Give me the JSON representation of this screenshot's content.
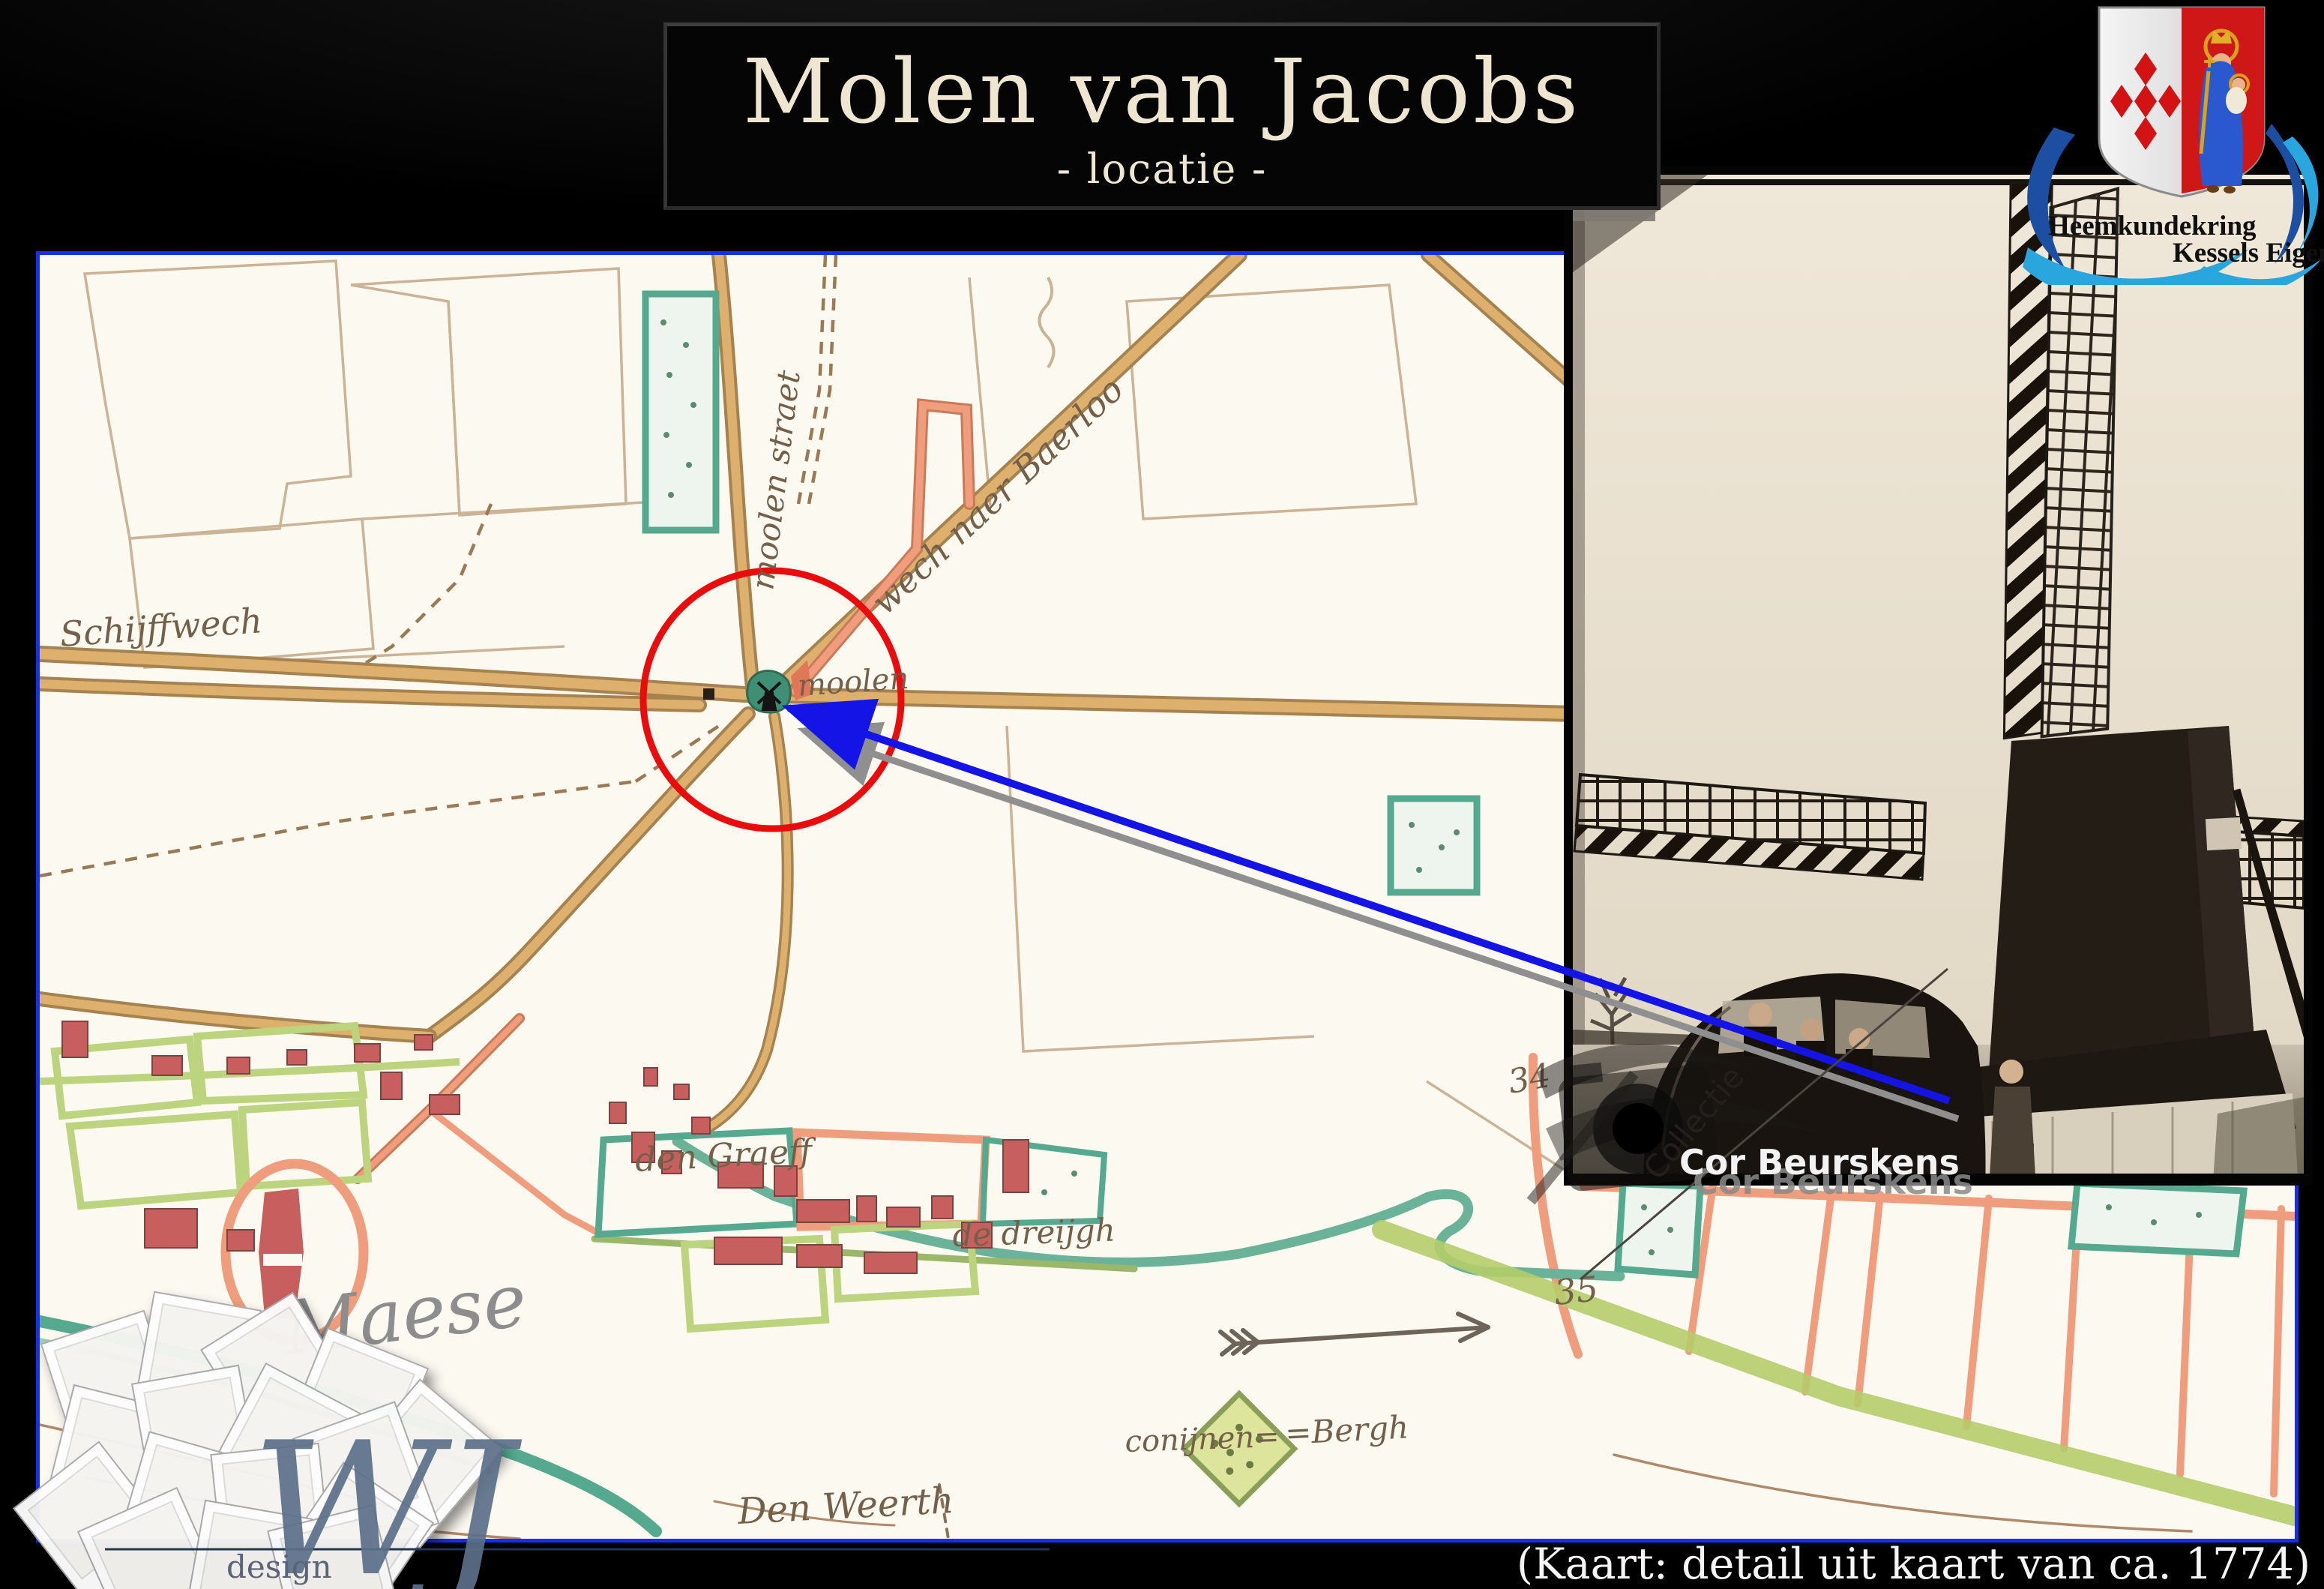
{
  "slide": {
    "title": "Molen van Jacobs",
    "subtitle": "- locatie -",
    "caption": "(Kaart: detail uit kaart van ca. 1774)",
    "background_color": "#000000",
    "title_color": "#efe6d2"
  },
  "logo": {
    "line1": "Heemkundekring",
    "line2": "Kessels Eigen",
    "shield_left_color": "#e2e2e2",
    "shield_right_color": "#cf1717",
    "lozenge_color": "#d31313",
    "swoosh_dark_color": "#1c4fa1",
    "swoosh_light_color": "#2aa6df"
  },
  "map": {
    "paper_color": "#fcf9f1",
    "border_color": "#1430ee",
    "highlight_circle_color": "#ea0c0c",
    "pointer_color": "#1414e6",
    "labels": {
      "schijffwech": "Schijffwech",
      "moolen_straet": "moolen straet",
      "wech_naer_baerloo": "wech naer Baerloo",
      "moolen": "moolen",
      "den_graeff": "den Graeff",
      "de_dreijgh": "de dreijgh",
      "maese": "Maese",
      "conijnen": "conijnen=",
      "bergh": "=Bergh",
      "den_weerth": "Den Weerth",
      "number_34": "34",
      "number_35": "35"
    }
  },
  "photo": {
    "watermark_collection": "Collectie",
    "watermark_name": "Cor Beurskens",
    "watermark_name_shadow": "Cor Beurskens"
  },
  "designer": {
    "monogram": "WJ",
    "label": "design"
  }
}
